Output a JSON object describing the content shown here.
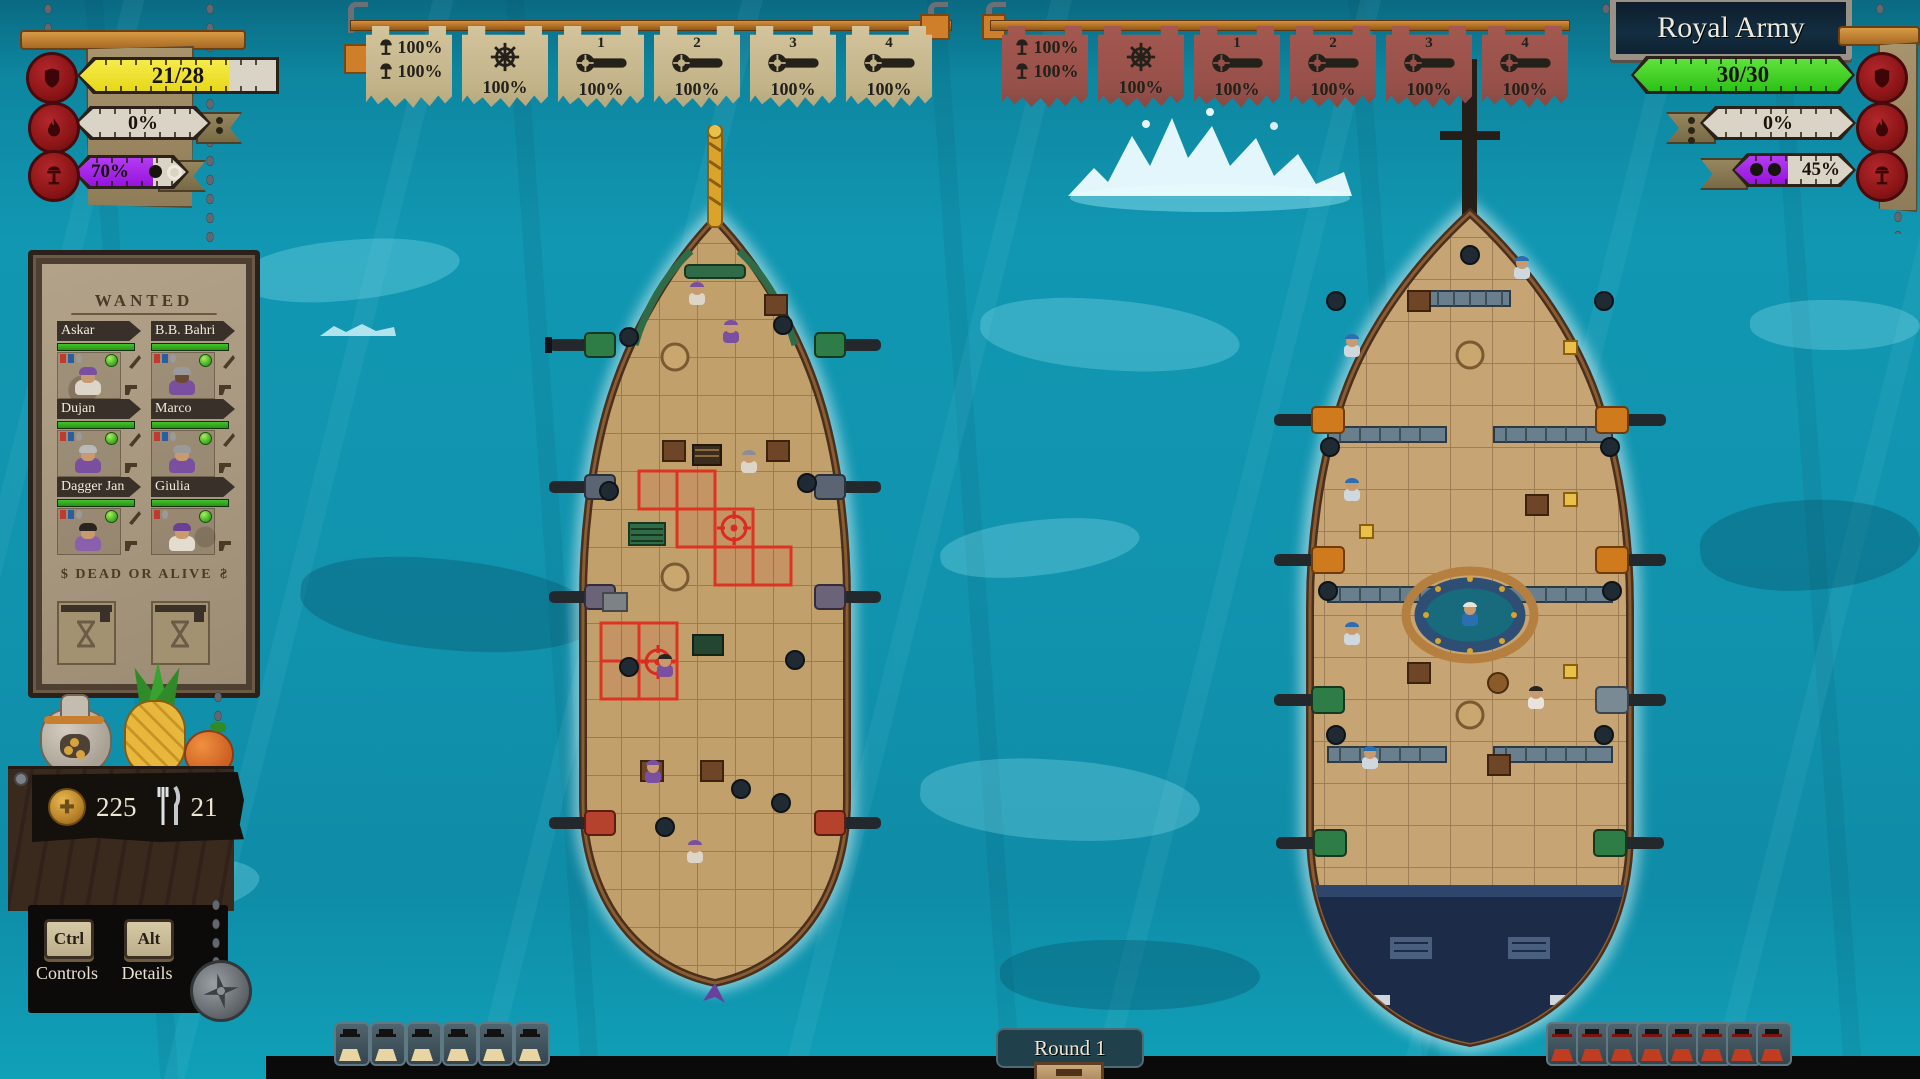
{
  "hud_left": {
    "bars": [
      {
        "name": "hull-integrity",
        "value": "21/28",
        "fill_style": "width:76%",
        "icon": "shield-seal-icon"
      },
      {
        "name": "fire-level",
        "value": "0%",
        "fill_style": "width:0%",
        "icon": "fire-seal-icon"
      },
      {
        "name": "ram-charge",
        "value": "70%",
        "fill_style": "width:70%",
        "icon": "ram-seal-icon",
        "pips_filled": 1,
        "pips_hollow": 1
      }
    ]
  },
  "hud_right": {
    "title": "Royal Army",
    "bars": [
      {
        "name": "hull-integrity",
        "value": "30/30",
        "fill_style": "width:100%",
        "icon": "shield-seal-icon"
      },
      {
        "name": "fire-level",
        "value": "0%",
        "fill_style": "width:0%",
        "icon": "fire-seal-icon"
      },
      {
        "name": "ram-charge",
        "value": "45%",
        "fill_style": "width:45%",
        "icon": "ram-seal-icon",
        "pips_filled": 2
      }
    ]
  },
  "banners": {
    "left": {
      "theme": "tan",
      "items": [
        {
          "icon": "mast-icon",
          "values": [
            "100%",
            "100%"
          ]
        },
        {
          "icon": "wheel-icon",
          "value": "100%"
        },
        {
          "icon": "cannon-icon",
          "number": "1",
          "value": "100%"
        },
        {
          "icon": "cannon-icon",
          "number": "2",
          "value": "100%"
        },
        {
          "icon": "cannon-icon",
          "number": "3",
          "value": "100%"
        },
        {
          "icon": "cannon-icon",
          "number": "4",
          "value": "100%"
        }
      ]
    },
    "right": {
      "theme": "red",
      "items": [
        {
          "icon": "mast-icon",
          "values": [
            "100%",
            "100%"
          ]
        },
        {
          "icon": "wheel-icon",
          "value": "100%"
        },
        {
          "icon": "cannon-icon",
          "number": "1",
          "value": "100%"
        },
        {
          "icon": "cannon-icon",
          "number": "2",
          "value": "100%"
        },
        {
          "icon": "cannon-icon",
          "number": "3",
          "value": "100%"
        },
        {
          "icon": "cannon-icon",
          "number": "4",
          "value": "100%"
        }
      ]
    }
  },
  "wanted": {
    "title": "WANTED",
    "crew": [
      {
        "name": "Askar"
      },
      {
        "name": "B.B. Bahri"
      },
      {
        "name": "Dujan"
      },
      {
        "name": "Marco"
      },
      {
        "name": "Dagger Jan"
      },
      {
        "name": "Giulia"
      }
    ],
    "bounty_symbol": "$",
    "bounty_text": "DEAD OR ALIVE"
  },
  "resources": {
    "gold": "225",
    "food": "21"
  },
  "controls": {
    "key1": "Ctrl",
    "label1": "Controls",
    "key2": "Alt",
    "label2": "Details"
  },
  "round": {
    "label": "Round 1"
  },
  "crew_counters": {
    "player": 6,
    "enemy": 8
  },
  "colors": {
    "water": "#1193ae",
    "banner_tan": "#c9ba92",
    "banner_red": "#9b5049",
    "bar_yellow": "#eee32b",
    "bar_green": "#3ed62a",
    "bar_purple": "#a21bec",
    "seal_red": "#8c1517",
    "hp_green": "#2ba31e"
  }
}
